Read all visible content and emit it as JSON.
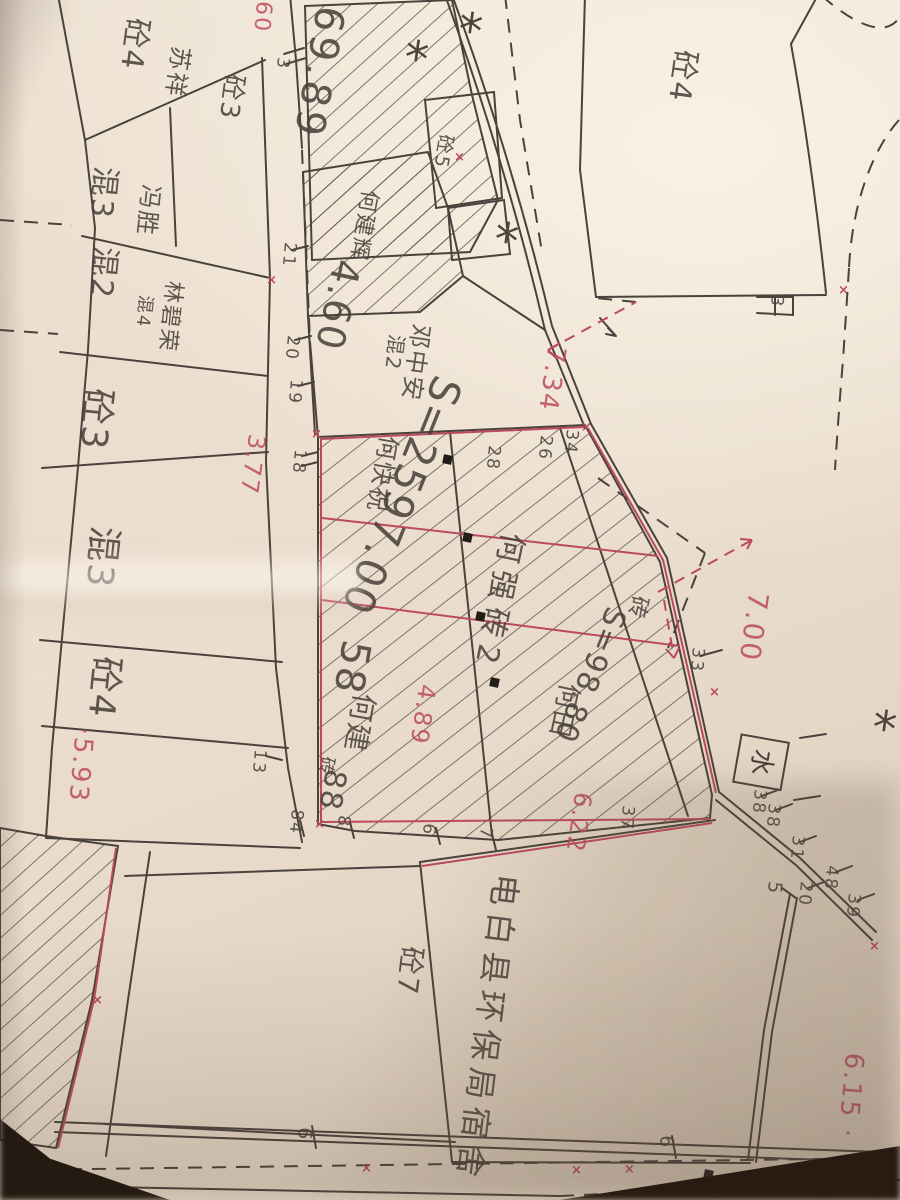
{
  "photo": {
    "paper_color": "#ece0d0",
    "ink_color": "#4a423c",
    "red_color": "#bb4a5e",
    "table_color": "#241a12"
  },
  "map": {
    "description_labels": [
      {
        "name": "building-type-label",
        "text": "砼4",
        "x": 152,
        "y": 20,
        "rot": 98,
        "size": 30,
        "color": "ink"
      },
      {
        "name": "owner-name-label",
        "text": "苏祥",
        "x": 193,
        "y": 48,
        "rot": 98,
        "size": 24,
        "color": "ink"
      },
      {
        "name": "building-type-label",
        "text": "砼3",
        "x": 247,
        "y": 76,
        "rot": 98,
        "size": 26,
        "color": "ink"
      },
      {
        "name": "building-type-label",
        "text": "混3",
        "x": 120,
        "y": 168,
        "rot": 96,
        "size": 30,
        "color": "ink"
      },
      {
        "name": "owner-name-label",
        "text": "冯胜",
        "x": 163,
        "y": 186,
        "rot": 96,
        "size": 24,
        "color": "ink"
      },
      {
        "name": "building-type-label",
        "text": "混2",
        "x": 120,
        "y": 248,
        "rot": 96,
        "size": 30,
        "color": "ink"
      },
      {
        "name": "owner-name-label",
        "text": "林碧荣",
        "x": 184,
        "y": 282,
        "rot": 96,
        "size": 22,
        "color": "ink"
      },
      {
        "name": "building-type-label",
        "text": "混4",
        "x": 154,
        "y": 296,
        "rot": 96,
        "size": 18,
        "color": "ink"
      },
      {
        "name": "building-type-label",
        "text": "砼3",
        "x": 116,
        "y": 390,
        "rot": 96,
        "size": 36,
        "color": "ink"
      },
      {
        "name": "building-type-label",
        "text": "混3",
        "x": 122,
        "y": 528,
        "rot": 96,
        "size": 36,
        "color": "ink"
      },
      {
        "name": "building-type-label",
        "text": "砼4",
        "x": 124,
        "y": 658,
        "rot": 96,
        "size": 36,
        "color": "ink"
      },
      {
        "name": "building-type-label",
        "text": "砼4",
        "x": 700,
        "y": 52,
        "rot": 98,
        "size": 30,
        "color": "ink"
      },
      {
        "name": "building-type-label",
        "text": "砼5",
        "x": 455,
        "y": 136,
        "rot": 100,
        "size": 19,
        "color": "ink"
      },
      {
        "name": "owner-name-label",
        "text": "何建辉",
        "x": 380,
        "y": 192,
        "rot": 100,
        "size": 22,
        "color": "ink"
      },
      {
        "name": "owner-name-label",
        "text": "邓中安",
        "x": 433,
        "y": 326,
        "rot": 98,
        "size": 24,
        "color": "ink"
      },
      {
        "name": "building-type-label",
        "text": "混2",
        "x": 407,
        "y": 336,
        "rot": 98,
        "size": 20,
        "color": "ink"
      },
      {
        "name": "owner-name-label",
        "text": "何快祝",
        "x": 401,
        "y": 438,
        "rot": 100,
        "size": 24,
        "color": "ink"
      },
      {
        "name": "owner-name-label",
        "text": "何强砖2",
        "x": 527,
        "y": 536,
        "rot": 102,
        "size": 30,
        "ls": 8,
        "color": "ink"
      },
      {
        "name": "building-type-label",
        "text": "砖",
        "x": 650,
        "y": 598,
        "rot": 102,
        "size": 22,
        "color": "ink"
      },
      {
        "name": "owner-name-label",
        "text": "何田",
        "x": 582,
        "y": 686,
        "rot": 102,
        "size": 26,
        "color": "ink"
      },
      {
        "name": "owner-name-label",
        "text": "何建",
        "x": 378,
        "y": 696,
        "rot": 100,
        "size": 28,
        "color": "ink"
      },
      {
        "name": "building-type-label",
        "text": "砖",
        "x": 336,
        "y": 758,
        "rot": 100,
        "size": 18,
        "color": "ink"
      },
      {
        "name": "owner-name-label",
        "text": "电白县环保局宿舍",
        "x": 522,
        "y": 876,
        "rot": 97,
        "size": 32,
        "ls": 7,
        "color": "ink"
      },
      {
        "name": "building-type-label",
        "text": "砼7",
        "x": 426,
        "y": 948,
        "rot": 97,
        "size": 28,
        "color": "ink"
      }
    ],
    "area_number_labels": [
      {
        "name": "area-label",
        "text": "69.89",
        "x": 350,
        "y": 10,
        "rot": 100,
        "size": 40,
        "ls": 4,
        "color": "ink"
      },
      {
        "name": "area-label",
        "text": "4.60",
        "x": 366,
        "y": 264,
        "rot": 102,
        "size": 38,
        "color": "ink"
      },
      {
        "name": "area-label",
        "text": "S=2597.00",
        "x": 468,
        "y": 386,
        "rot": 112,
        "size": 42,
        "ls": 2,
        "color": "ink"
      },
      {
        "name": "area-label",
        "text": "58",
        "x": 376,
        "y": 644,
        "rot": 100,
        "size": 40,
        "color": "ink"
      },
      {
        "name": "area-label",
        "text": "88",
        "x": 350,
        "y": 772,
        "rot": 100,
        "size": 30,
        "color": "ink"
      },
      {
        "name": "area-label",
        "text": "S=98.80",
        "x": 630,
        "y": 614,
        "rot": 112,
        "size": 30,
        "color": "ink"
      }
    ],
    "point_number_labels": [
      {
        "name": "point-number-label",
        "text": "3",
        "x": 291,
        "y": 58,
        "rot": 95,
        "size": 17,
        "color": "ink"
      },
      {
        "name": "point-number-label",
        "text": "21",
        "x": 298,
        "y": 243,
        "rot": 95,
        "size": 17,
        "color": "ink"
      },
      {
        "name": "point-number-label",
        "text": "20",
        "x": 301,
        "y": 336,
        "rot": 95,
        "size": 17,
        "color": "ink"
      },
      {
        "name": "point-number-label",
        "text": "19",
        "x": 304,
        "y": 380,
        "rot": 95,
        "size": 17,
        "color": "ink"
      },
      {
        "name": "point-number-label",
        "text": "18",
        "x": 308,
        "y": 450,
        "rot": 95,
        "size": 17,
        "color": "ink"
      },
      {
        "name": "point-number-label",
        "text": "13",
        "x": 268,
        "y": 750,
        "rot": 95,
        "size": 17,
        "color": "ink"
      },
      {
        "name": "point-number-label",
        "text": "84",
        "x": 305,
        "y": 810,
        "rot": 95,
        "size": 17,
        "color": "ink"
      },
      {
        "name": "point-number-label",
        "text": "8",
        "x": 352,
        "y": 816,
        "rot": 95,
        "size": 17,
        "color": "ink"
      },
      {
        "name": "point-number-label",
        "text": "6",
        "x": 437,
        "y": 824,
        "rot": 95,
        "size": 17,
        "color": "ink"
      },
      {
        "name": "point-number-label",
        "text": "7",
        "x": 494,
        "y": 828,
        "rot": 95,
        "size": 17,
        "color": "ink"
      },
      {
        "name": "point-number-label",
        "text": "33",
        "x": 706,
        "y": 648,
        "rot": 95,
        "size": 17,
        "color": "ink"
      },
      {
        "name": "point-number-label",
        "text": "34",
        "x": 580,
        "y": 430,
        "rot": 95,
        "size": 17,
        "color": "ink"
      },
      {
        "name": "point-number-label",
        "text": "26",
        "x": 554,
        "y": 436,
        "rot": 95,
        "size": 17,
        "color": "ink"
      },
      {
        "name": "point-number-label",
        "text": "28",
        "x": 502,
        "y": 446,
        "rot": 95,
        "size": 17,
        "color": "ink"
      },
      {
        "name": "point-number-label",
        "text": "38",
        "x": 768,
        "y": 790,
        "rot": 95,
        "size": 17,
        "color": "ink"
      },
      {
        "name": "point-number-label",
        "text": "38",
        "x": 782,
        "y": 804,
        "rot": 95,
        "size": 17,
        "color": "ink"
      },
      {
        "name": "point-number-label",
        "text": "31",
        "x": 806,
        "y": 836,
        "rot": 95,
        "size": 17,
        "color": "ink"
      },
      {
        "name": "point-number-label",
        "text": "20",
        "x": 814,
        "y": 882,
        "rot": 95,
        "size": 17,
        "color": "ink"
      },
      {
        "name": "point-number-label",
        "text": "48",
        "x": 840,
        "y": 866,
        "rot": 95,
        "size": 17,
        "color": "ink"
      },
      {
        "name": "point-number-label",
        "text": "39",
        "x": 862,
        "y": 894,
        "rot": 95,
        "size": 17,
        "color": "ink"
      },
      {
        "name": "point-number-label",
        "text": "5",
        "x": 784,
        "y": 882,
        "rot": 95,
        "size": 19,
        "color": "ink"
      },
      {
        "name": "point-number-label",
        "text": "3",
        "x": 785,
        "y": 296,
        "rot": 95,
        "size": 17,
        "color": "ink"
      },
      {
        "name": "point-number-label",
        "text": "37",
        "x": 636,
        "y": 806,
        "rot": 95,
        "size": 17,
        "color": "ink"
      },
      {
        "name": "point-number-label",
        "text": "6",
        "x": 314,
        "y": 1128,
        "rot": 95,
        "size": 19,
        "color": "ink"
      },
      {
        "name": "point-number-label",
        "text": "6",
        "x": 676,
        "y": 1136,
        "rot": 95,
        "size": 19,
        "color": "ink"
      }
    ],
    "dimension_labels": [
      {
        "name": "dimension-label",
        "text": "60",
        "x": 274,
        "y": 2,
        "rot": 95,
        "size": 22,
        "color": "red"
      },
      {
        "name": "dimension-label",
        "text": "3.77",
        "x": 269,
        "y": 436,
        "rot": 98,
        "size": 24,
        "color": "red"
      },
      {
        "name": "dimension-label",
        "text": "7.34",
        "x": 569,
        "y": 348,
        "rot": 98,
        "size": 26,
        "color": "red"
      },
      {
        "name": "dimension-label",
        "text": "7.00",
        "x": 772,
        "y": 594,
        "rot": 98,
        "size": 28,
        "color": "red"
      },
      {
        "name": "dimension-label",
        "text": "4.89",
        "x": 439,
        "y": 686,
        "rot": 98,
        "size": 24,
        "color": "red"
      },
      {
        "name": "dimension-label",
        "text": "6.22",
        "x": 595,
        "y": 794,
        "rot": 98,
        "size": 24,
        "color": "red"
      },
      {
        "name": "dimension-label",
        "text": "·5.93",
        "x": 97,
        "y": 728,
        "rot": 95,
        "size": 26,
        "color": "red"
      },
      {
        "name": "dimension-label",
        "text": "6.15 ·",
        "x": 867,
        "y": 1054,
        "rot": 95,
        "size": 26,
        "color": "red"
      }
    ],
    "water_symbol": {
      "name": "water-meter-symbol",
      "text": "水",
      "x": 790,
      "y": 742,
      "rot": 100,
      "size": 26,
      "box": 46
    }
  },
  "symbols": {
    "tree_glyph": "*",
    "cross_glyph": "×",
    "trees": [
      [
        462,
        2
      ],
      [
        408,
        30
      ],
      [
        498,
        212
      ],
      [
        876,
        700
      ]
    ],
    "squares": [
      [
        443,
        455
      ],
      [
        463,
        533
      ],
      [
        476,
        612
      ],
      [
        490,
        678
      ],
      [
        704,
        1170
      ]
    ],
    "crosses": [
      [
        266,
        273
      ],
      [
        311,
        427
      ],
      [
        454,
        150
      ],
      [
        838,
        283
      ],
      [
        709,
        685
      ],
      [
        361,
        1161
      ],
      [
        571,
        1163
      ],
      [
        624,
        1162
      ],
      [
        92,
        993
      ],
      [
        869,
        939
      ],
      [
        581,
        420
      ],
      [
        314,
        817
      ]
    ]
  }
}
